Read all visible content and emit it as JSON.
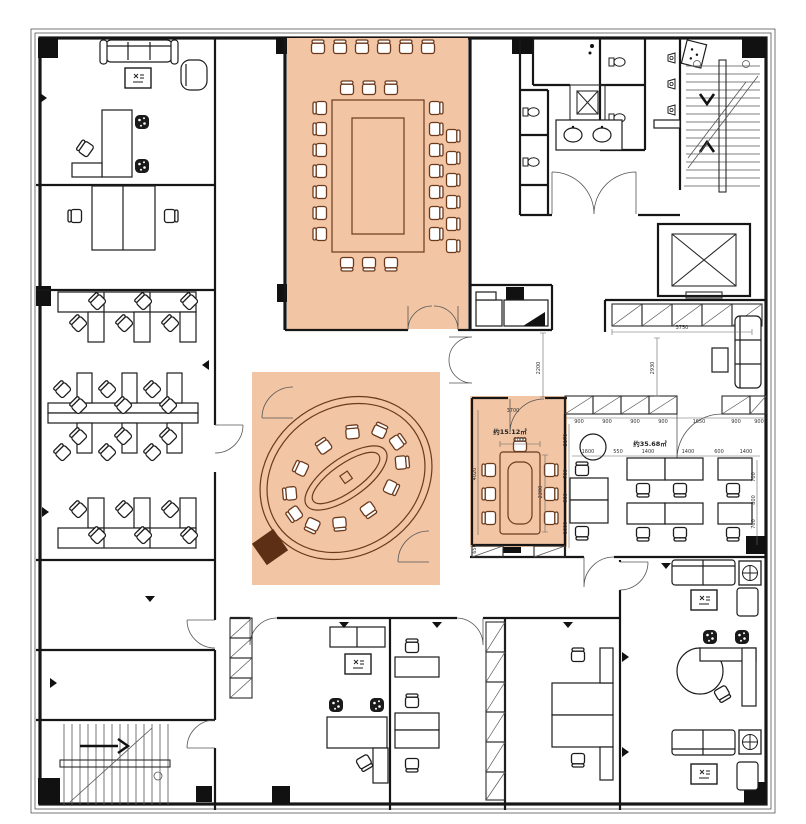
{
  "title": "office-floor-plan",
  "colors": {
    "highlight": "#f2c5a4",
    "brown": "#6b3a1d",
    "brown_dark": "#5d2f14",
    "wall": "#161616",
    "dim_text": "#333333"
  },
  "areas": {
    "small_meeting": "约15.12㎡",
    "open_office": "约35.68㎡"
  },
  "dims": {
    "corridor": "2200",
    "lounge_w": "3750",
    "lounge_h": "2930",
    "cabinets": [
      "900",
      "900",
      "900",
      "900",
      "1650",
      "900",
      "900"
    ],
    "office_left": [
      "2170",
      "700",
      "800",
      "1000"
    ],
    "office_top": [
      "1600",
      "550",
      "1400",
      "1400",
      "600",
      "1400"
    ],
    "office_right": [
      "700",
      "800",
      "700"
    ],
    "meeting_top": "3700",
    "meeting_w": "1000",
    "meeting_left": "4020",
    "meeting_h": "2200",
    "meeting_b_left": "650"
  }
}
